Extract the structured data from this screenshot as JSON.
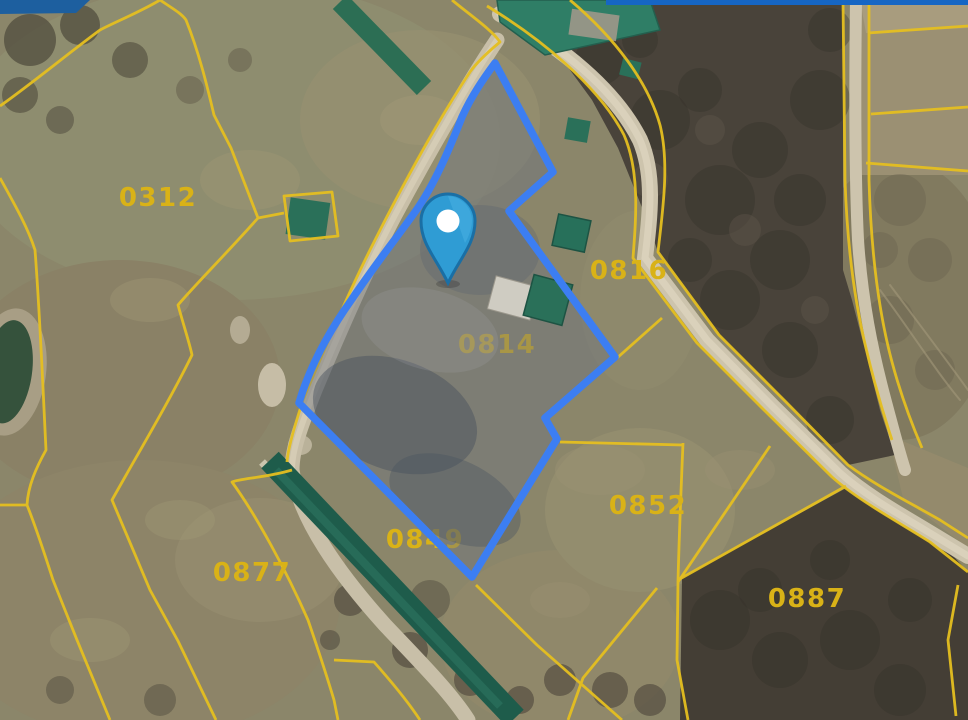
{
  "map": {
    "description": "Satellite cadastral map with highlighted parcel and location pin",
    "selected_parcel_id": "0814",
    "marker": {
      "name": "location-pin",
      "fill": "#2f9cd4",
      "ring": "#ffffff"
    },
    "parcels": [
      {
        "id": "0312",
        "selected": false
      },
      {
        "id": "0814",
        "selected": true
      },
      {
        "id": "0816",
        "selected": false
      },
      {
        "id": "0849",
        "selected": false
      },
      {
        "id": "0852",
        "selected": false
      },
      {
        "id": "0877",
        "selected": false
      },
      {
        "id": "0887",
        "selected": false
      }
    ],
    "colors": {
      "cadastral_line": "#e5bf20",
      "parcel_label": "#d9b217",
      "selected_outline": "#3c7ef2",
      "road": "#cdc4ad",
      "field": "#8b866a",
      "forest": "#49433a",
      "greenhouse": "#1e5c4b"
    }
  }
}
